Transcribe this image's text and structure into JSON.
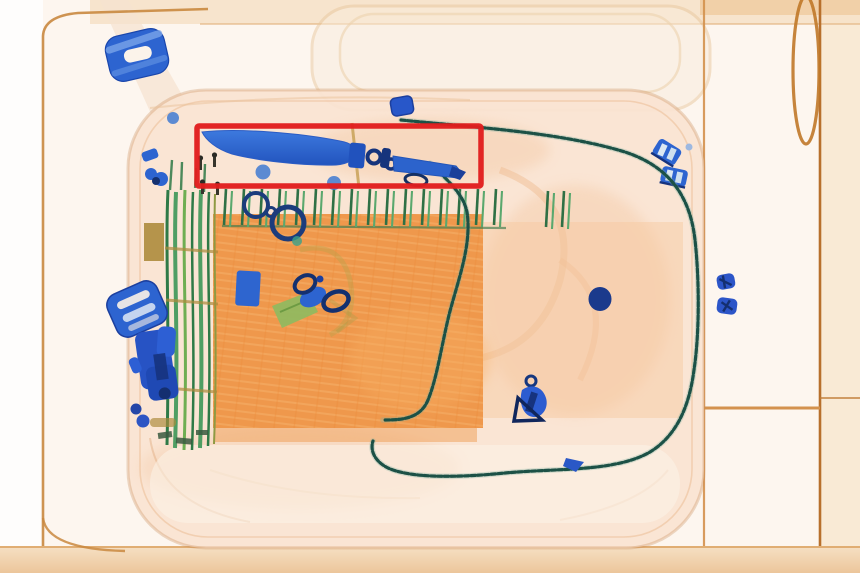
{
  "scene": {
    "description": "Airport security X-ray scan of a suitcase; a knife is flagged with a red alert rectangle",
    "objects": [
      "conveyor-frame",
      "inspection-tray",
      "suitcase",
      "clothes-block",
      "tent-pole-rack",
      "comb-teeth-strip",
      "knife",
      "threat-alert-box",
      "beaded-lanyard-cable",
      "cable-clips",
      "carabiner-rings",
      "scissors",
      "metal-plate",
      "metal-disc",
      "key-charm",
      "slider-buckle",
      "ladder-buckle",
      "multitool-blob",
      "metal-knot-pair",
      "metal-diamond",
      "metal-dot-pair",
      "small-bolts"
    ]
  },
  "annotation": {
    "type": "threat-box",
    "item": "knife",
    "color": "#e11d1d"
  },
  "colors": {
    "bg": "#fdf6ef",
    "margin_white": "#fefdfc",
    "band_tan": "#f6e2c9",
    "band_deep": "#efcda4",
    "frame_line": "#c9883f",
    "frame_line_dark": "#b06a24",
    "bag_fill": "#fae4d2",
    "bag_edge": "#d9a26b",
    "cloth_orange": "#ee9445",
    "cloth_light": "#f5b06a",
    "metal_blue": "#2d64d0",
    "metal_blue_dark": "#1c3f9e",
    "navy": "#14306f",
    "green_organic": "#4f9e63",
    "green_dark": "#2e7a47",
    "olive": "#ad8b3c",
    "cable_teal": "#1c5146",
    "alert_red": "#e11d1d",
    "dot_blue": "#3f7ad1"
  }
}
